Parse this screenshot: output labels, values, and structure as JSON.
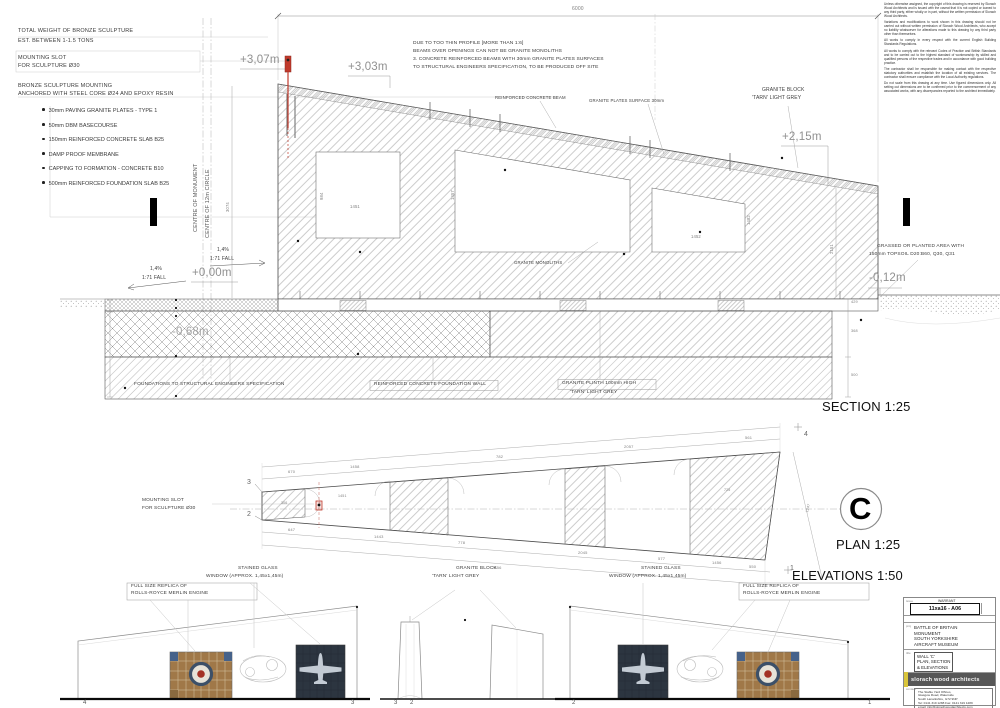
{
  "notes_top_left": {
    "heading1": "TOTAL WEIGHT OF BRONZE SCULPTURE",
    "heading2": "EST. BETWEEN 1-1.5 TONS",
    "mounting1": "MOUNTING SLOT",
    "mounting2": "FOR SCULPTURE Ø30",
    "anchor1": "BRONZE SCULPTURE MOUNTING",
    "anchor2": "ANCHORED WITH STEEL CORE Ø24 AND EPOXY RESIN",
    "bullets": [
      "30mm PAVING GRANITE PLATES - TYPE 1",
      "50mm DBM BASECOURSE",
      "150mm REINFORCED CONCRETE SLAB B25",
      "DAMP PROOF MEMBRANE",
      "CAPPING TO FORMATION - CONCRETE B10",
      "500mm REINFORCED FOUNDATION SLAB B25"
    ]
  },
  "notes_beams": {
    "lines": [
      "DUE TO TOO THIN PROFILE [MORE THAN 1:6]",
      "BEAMS OVER OPENINGS CAN NOT BE GRANITE MONOLITHS",
      "3. CONCRETE REINFORCED BEAMS WITH 30mm GRANITE PLATES SURFACES",
      "TO STRUCTURAL ENGINEERS SPECIFICATION, TO BE PRODUCED OFF SITE"
    ]
  },
  "disclaimer": {
    "paragraphs": [
      "Unless otherwise assigned, the copyright of this drawing is reserved by Slorach Wood Architects and is issued with the caveat that it is not copied or loaned to any third party, either wholly or in part, without the written permission of Slorach Wood Architects.",
      "Variations and modifications to work shown in this drawing should not be carried out without written permission of Slorach Wood Architects, who accept no liability whatsoever for alterations made to this drawing by any third party other than themselves.",
      "All works to comply in every respect with the current English Building Standards Regulations.",
      "All works to comply with the relevant Codes of Practice and British Standards and to be carried out to the highest standard of workmanship by skilled and qualified persons of the respective trades and in accordance with good building practice.",
      "The contractor shall be responsible for making contact with the respective statutory authorities and establish the location of all existing services. The contractor shall ensure compliance with the Local Authority regulations.",
      "Do not scale from this drawing at any time. Use figured dimensions only. All setting out dimensions are to be confirmed prior to the commencement of any associated works, with any discrepancies reported to the architect immediately."
    ]
  },
  "title_block": {
    "issue_label": "issue",
    "warrant": "WARRANT",
    "drawing_number": "11xa16 - A06",
    "project_label": "proj",
    "project_lines": [
      "BATTLE OF BRITAIN",
      "MONUMENT",
      "SOUTH YORKSHIRE",
      "AIRCRAFT MUSEUM"
    ],
    "title_label": "title",
    "title_lines": [
      "WALL 'C'",
      "PLAN, SECTION",
      "& ELEVATIONS"
    ],
    "firm": "slorach wood architects",
    "contact_label": "contact",
    "contact_lines": [
      "The Stable Yard Offices,",
      "Glasgow Road, Waterside",
      "South Lanarkshire, G72 9NP",
      "Tel: 0141 319 1288  Fax: 0141 319 1289",
      "email: info@slorachwoodarchitects.com"
    ]
  },
  "colors": {
    "accent_red": "#c0392b",
    "logo_yellow": "#d9c53b",
    "logo_grey": "#575757",
    "glass_navy": "#2c3540",
    "glass_amber": "#a07848"
  },
  "annotations": [
    {
      "n": "note-reinforced-beam",
      "t": "REINFORCED CONCRETE BEAM",
      "x": 495,
      "y": 96,
      "s": 4.3
    },
    {
      "n": "note-granite-plates",
      "t": "GRANITE PLATES SURFACE 30mm",
      "x": 589,
      "y": 99,
      "s": 4.3
    },
    {
      "n": "note-granite-block-1",
      "t": "GRANITE BLOCK",
      "x": 762,
      "y": 88,
      "s": 5
    },
    {
      "n": "note-granite-block-2",
      "t": "'TARN' LIGHT GREY",
      "x": 752,
      "y": 96,
      "s": 5
    },
    {
      "n": "level-plus-3-07",
      "t": "+3,07m",
      "x": 240,
      "y": 55,
      "s": 11.5,
      "c": "#909090"
    },
    {
      "n": "level-plus-3-03",
      "t": "+3,03m",
      "x": 348,
      "y": 62,
      "s": 11.5,
      "c": "#909090"
    },
    {
      "n": "level-plus-2-15",
      "t": "+2,15m",
      "x": 782,
      "y": 132,
      "s": 11.5,
      "c": "#909090"
    },
    {
      "n": "level-zero",
      "t": "+0,00m",
      "x": 192,
      "y": 268,
      "s": 11.5,
      "c": "#909090"
    },
    {
      "n": "level-minus-0-12",
      "t": "-0,12m",
      "x": 869,
      "y": 273,
      "s": 11.5,
      "c": "#909090"
    },
    {
      "n": "level-minus-0-68",
      "t": "-0,68m",
      "x": 172,
      "y": 327,
      "s": 11.5,
      "c": "#a5a5a5"
    },
    {
      "n": "fall-left-pct",
      "t": "1,4%",
      "x": 150,
      "y": 267,
      "s": 5
    },
    {
      "n": "fall-left-ratio",
      "t": "1:71 FALL",
      "x": 142,
      "y": 276,
      "s": 5
    },
    {
      "n": "fall-right-pct",
      "t": "1,4%",
      "x": 217,
      "y": 248,
      "s": 5
    },
    {
      "n": "fall-right-ratio",
      "t": "1:71 FALL",
      "x": 210,
      "y": 257,
      "s": 5
    },
    {
      "n": "note-granite-monoliths",
      "t": "GRANITE MONOLITHS",
      "x": 514,
      "y": 261,
      "s": 4.3
    },
    {
      "n": "note-foundations-spec",
      "t": "FOUNDATIONS TO STRUCTURAL ENGINEERS SPECIFICATION",
      "x": 134,
      "y": 383,
      "s": 4.8
    },
    {
      "n": "note-foundation-wall",
      "t": "REINFORCED CONCRETE FOUNDATION WALL",
      "x": 374,
      "y": 383,
      "s": 4.8
    },
    {
      "n": "note-plinth-1",
      "t": "GRANITE PLINTH 100mm HIGH",
      "x": 562,
      "y": 382,
      "s": 4.8
    },
    {
      "n": "note-plinth-2",
      "t": "'TARN' LIGHT GREY",
      "x": 570,
      "y": 391,
      "s": 4.8
    },
    {
      "n": "note-grassed-1",
      "t": "GRASSED OR PLANTED AREA WITH",
      "x": 877,
      "y": 245,
      "s": 4.8
    },
    {
      "n": "note-grassed-2",
      "t": "150mm TOPSOIL D20:B60, Q30, Q31",
      "x": 869,
      "y": 253,
      "s": 4.8
    },
    {
      "n": "scale-section",
      "t": "SECTION 1:25",
      "x": 822,
      "y": 400,
      "s": 13,
      "c": "#111"
    },
    {
      "n": "dim-6000",
      "t": "6000",
      "x": 572,
      "y": 7,
      "s": 5,
      "c": "#808080"
    },
    {
      "n": "dim-3074",
      "t": "3074",
      "x": 226,
      "y": 212,
      "s": 4.2,
      "c": "#808080",
      "r": -90
    },
    {
      "n": "dim-2151",
      "t": "2151",
      "x": 830,
      "y": 254,
      "s": 4.2,
      "c": "#808080",
      "r": -90
    },
    {
      "n": "dim-429",
      "t": "429",
      "x": 851,
      "y": 301,
      "s": 3.8,
      "c": "#808080"
    },
    {
      "n": "dim-368",
      "t": "368",
      "x": 851,
      "y": 330,
      "s": 3.8,
      "c": "#808080"
    },
    {
      "n": "dim-500",
      "t": "500",
      "x": 851,
      "y": 374,
      "s": 3.8,
      "c": "#808080"
    },
    {
      "n": "dim-1451",
      "t": "1451",
      "x": 350,
      "y": 205,
      "s": 4.2,
      "c": "#808080"
    },
    {
      "n": "dim-984",
      "t": "984",
      "x": 320,
      "y": 200,
      "s": 4.2,
      "c": "#808080",
      "r": -90
    },
    {
      "n": "dim-1452",
      "t": "1452",
      "x": 691,
      "y": 235,
      "s": 4.2,
      "c": "#808080"
    },
    {
      "n": "dim-1482",
      "t": "1482",
      "x": 747,
      "y": 225,
      "s": 4.2,
      "c": "#808080",
      "r": -90
    },
    {
      "n": "dim-1457",
      "t": "1457",
      "x": 451,
      "y": 200,
      "s": 4.2,
      "c": "#808080",
      "r": -90
    },
    {
      "n": "centreline-label-monument",
      "t": "CENTRE OF MONUMENT",
      "x": 194,
      "y": 232,
      "s": 5.5,
      "c": "#555",
      "r": -90
    },
    {
      "n": "centreline-label-circle",
      "t": "CENTRE OF 12m CIRCLE",
      "x": 206,
      "y": 238,
      "s": 5.5,
      "c": "#555",
      "r": -90
    },
    {
      "n": "plan-mounting-1",
      "t": "MOUNTING SLOT",
      "x": 142,
      "y": 499,
      "s": 4.8
    },
    {
      "n": "plan-mounting-2",
      "t": "FOR SCULPTURE Ø30",
      "x": 142,
      "y": 507,
      "s": 4.8
    },
    {
      "n": "plan-dim-670",
      "t": "670",
      "x": 288,
      "y": 470,
      "s": 4,
      "c": "#808080"
    },
    {
      "n": "plan-dim-1458",
      "t": "1458",
      "x": 350,
      "y": 465,
      "s": 4,
      "c": "#808080"
    },
    {
      "n": "plan-dim-782",
      "t": "782",
      "x": 496,
      "y": 455,
      "s": 4,
      "c": "#808080"
    },
    {
      "n": "plan-dim-2057",
      "t": "2057",
      "x": 624,
      "y": 445,
      "s": 4,
      "c": "#808080"
    },
    {
      "n": "plan-dim-561",
      "t": "561",
      "x": 745,
      "y": 436,
      "s": 4,
      "c": "#808080"
    },
    {
      "n": "plan-dim-647",
      "t": "647",
      "x": 288,
      "y": 528,
      "s": 4,
      "c": "#808080"
    },
    {
      "n": "plan-dim-1443",
      "t": "1443",
      "x": 374,
      "y": 535,
      "s": 4,
      "c": "#808080"
    },
    {
      "n": "plan-dim-778",
      "t": "778",
      "x": 458,
      "y": 541,
      "s": 4,
      "c": "#808080"
    },
    {
      "n": "plan-dim-2045",
      "t": "2045",
      "x": 578,
      "y": 551,
      "s": 4,
      "c": "#808080"
    },
    {
      "n": "plan-dim-577",
      "t": "577",
      "x": 658,
      "y": 557,
      "s": 4,
      "c": "#808080"
    },
    {
      "n": "plan-dim-1456",
      "t": "1456",
      "x": 712,
      "y": 561,
      "s": 4,
      "c": "#808080"
    },
    {
      "n": "plan-dim-550",
      "t": "550",
      "x": 749,
      "y": 565,
      "s": 4,
      "c": "#808080"
    },
    {
      "n": "plan-dim-7456",
      "t": "7456",
      "x": 492,
      "y": 566,
      "s": 4,
      "c": "#808080"
    },
    {
      "n": "plan-dim-306",
      "t": "306",
      "x": 281,
      "y": 502,
      "s": 3.6,
      "c": "#808080"
    },
    {
      "n": "plan-dim-1451",
      "t": "1451",
      "x": 338,
      "y": 495,
      "s": 3.6,
      "c": "#808080"
    },
    {
      "n": "plan-dim-725",
      "t": "725",
      "x": 724,
      "y": 489,
      "s": 3.6,
      "c": "#808080"
    },
    {
      "n": "plan-dim-1247",
      "t": "1247",
      "x": 806,
      "y": 512,
      "s": 3.6,
      "c": "#808080",
      "r": -75
    },
    {
      "n": "plan-grid-3",
      "t": "3",
      "x": 247,
      "y": 479,
      "s": 7,
      "c": "#666"
    },
    {
      "n": "plan-grid-2",
      "t": "2",
      "x": 247,
      "y": 511,
      "s": 7,
      "c": "#666"
    },
    {
      "n": "plan-grid-4",
      "t": "4",
      "x": 804,
      "y": 431,
      "s": 7,
      "c": "#666"
    },
    {
      "n": "plan-grid-1",
      "t": "1",
      "x": 790,
      "y": 565,
      "s": 7,
      "c": "#666"
    },
    {
      "n": "wall-reference-letter",
      "t": "C",
      "x": 849,
      "y": 493,
      "s": 31,
      "c": "#000",
      "fw": 700
    },
    {
      "n": "scale-plan",
      "t": "PLAN 1:25",
      "x": 836,
      "y": 538,
      "s": 13,
      "c": "#111"
    },
    {
      "n": "scale-elevations",
      "t": "ELEVATIONS 1:50",
      "x": 792,
      "y": 569,
      "s": 13,
      "c": "#111"
    },
    {
      "n": "elev-left-window-1",
      "t": "STAINED GLASS",
      "x": 238,
      "y": 567,
      "s": 4.8
    },
    {
      "n": "elev-left-window-2",
      "t": "WINDOW (APPROX. 1,45x1,45m)",
      "x": 206,
      "y": 575,
      "s": 4.8
    },
    {
      "n": "elev-left-replica-1",
      "t": "FULL SIZE REPLICA OF",
      "x": 131,
      "y": 585,
      "s": 4.8
    },
    {
      "n": "elev-left-replica-2",
      "t": "ROLLS-ROYCE MERLIN ENGINE",
      "x": 131,
      "y": 592,
      "s": 4.8
    },
    {
      "n": "elev-mid-block-1",
      "t": "GRANITE BLOCK",
      "x": 456,
      "y": 567,
      "s": 4.8
    },
    {
      "n": "elev-mid-block-2",
      "t": "'TARN' LIGHT GREY",
      "x": 432,
      "y": 575,
      "s": 4.8
    },
    {
      "n": "elev-right-window-1",
      "t": "STAINED GLASS",
      "x": 641,
      "y": 567,
      "s": 4.8
    },
    {
      "n": "elev-right-window-2",
      "t": "WINDOW (APPROX. 1,45x1,45m)",
      "x": 609,
      "y": 575,
      "s": 4.8
    },
    {
      "n": "elev-right-replica-1",
      "t": "FULL SIZE REPLICA OF",
      "x": 743,
      "y": 585,
      "s": 4.8
    },
    {
      "n": "elev-right-replica-2",
      "t": "ROLLS-ROYCE MERLIN ENGINE",
      "x": 743,
      "y": 592,
      "s": 4.8
    },
    {
      "n": "elev-grid-4",
      "t": "4",
      "x": 83,
      "y": 700,
      "s": 6,
      "c": "#555"
    },
    {
      "n": "elev-grid-3a",
      "t": "3",
      "x": 351,
      "y": 700,
      "s": 6,
      "c": "#555"
    },
    {
      "n": "elev-grid-3b",
      "t": "3",
      "x": 394,
      "y": 700,
      "s": 6,
      "c": "#555"
    },
    {
      "n": "elev-grid-2a",
      "t": "2",
      "x": 410,
      "y": 700,
      "s": 6,
      "c": "#555"
    },
    {
      "n": "elev-grid-2b",
      "t": "2",
      "x": 572,
      "y": 700,
      "s": 6,
      "c": "#555"
    },
    {
      "n": "elev-grid-1",
      "t": "1",
      "x": 868,
      "y": 700,
      "s": 6,
      "c": "#555"
    }
  ]
}
